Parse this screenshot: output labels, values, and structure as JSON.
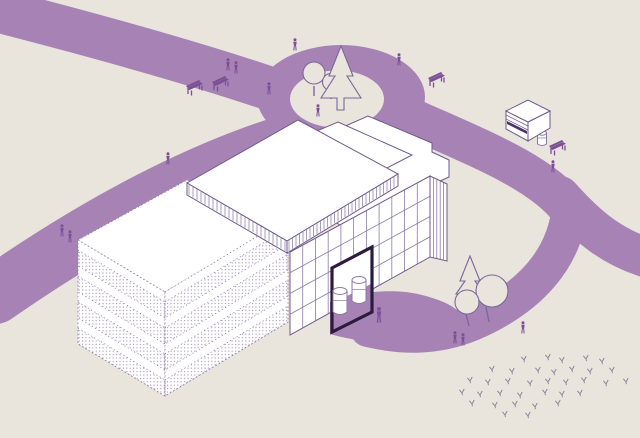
{
  "scene": {
    "kind": "isometric-architectural-site-illustration",
    "width": 640,
    "height": 438
  },
  "colors": {
    "background": "#e9e4dc",
    "road": "#a783b5",
    "solid_figure": "#7c4f97",
    "line_solid": "#6d5a8e",
    "line_dotted": "#9182ad",
    "glass_line": "#8a7aa8",
    "door_frame": "#2c1a3f",
    "grass": "#8b7d99",
    "tree_outline": "#7b689b",
    "dot_fill": "#a995bd",
    "hatch": "#8274a2",
    "white": "#ffffff",
    "kiosk_dark": "#4a3568"
  },
  "roads": {
    "ribbons": [
      {
        "name": "road-northwest",
        "d": "M-12,8 C90,34 190,62 268,88",
        "w": 44
      },
      {
        "name": "road-southwest",
        "d": "M292,142 C200,170 100,222 -5,295",
        "w": 58
      },
      {
        "name": "road-east",
        "d": "M398,112 C470,145 540,170 570,210",
        "w": 40
      },
      {
        "name": "road-east-branch",
        "d": "M560,196 C590,230 615,248 648,258",
        "w": 40
      },
      {
        "name": "road-entrance",
        "d": "M570,205 C566,258 530,298 472,323 C436,338 402,337 368,329",
        "w": 36
      }
    ],
    "roundabout": {
      "cx": 341,
      "cy": 97,
      "rx": 84,
      "ry": 52,
      "island_cx": 337,
      "island_cy": 99,
      "island_rx": 47,
      "island_ry": 28.5
    },
    "entrance_apron_d": "M330,302 C358,291 396,288 422,295 C446,301 459,309 461,316 C448,331 418,341 384,342 C362,342 344,338 330,334 Z",
    "door_floor": [
      [
        333,
        303
      ],
      [
        371,
        284
      ],
      [
        371,
        311
      ],
      [
        333,
        331
      ]
    ]
  },
  "building": {
    "wing": {
      "roof": [
        [
          78,
          240
        ],
        [
          187,
          180
        ],
        [
          290,
          218
        ],
        [
          165,
          292
        ]
      ],
      "end_face": [
        [
          78,
          240
        ],
        [
          165,
          292
        ],
        [
          165,
          396
        ],
        [
          78,
          344
        ]
      ],
      "front_face": [
        [
          165,
          292
        ],
        [
          288,
          218
        ],
        [
          288,
          322
        ],
        [
          165,
          396
        ]
      ],
      "bands": [
        [
          [
            78,
            250
          ],
          [
            165,
            302
          ],
          [
            165,
            318
          ],
          [
            78,
            266
          ]
        ],
        [
          [
            78,
            276
          ],
          [
            165,
            328
          ],
          [
            165,
            344
          ],
          [
            78,
            292
          ]
        ],
        [
          [
            78,
            302
          ],
          [
            165,
            354
          ],
          [
            165,
            370
          ],
          [
            78,
            318
          ]
        ],
        [
          [
            78,
            328
          ],
          [
            165,
            380
          ],
          [
            165,
            396
          ],
          [
            78,
            344
          ]
        ],
        [
          [
            165,
            302
          ],
          [
            288,
            228
          ],
          [
            288,
            244
          ],
          [
            165,
            318
          ]
        ],
        [
          [
            165,
            328
          ],
          [
            288,
            254
          ],
          [
            288,
            270
          ],
          [
            165,
            344
          ]
        ],
        [
          [
            165,
            354
          ],
          [
            288,
            280
          ],
          [
            288,
            296
          ],
          [
            165,
            370
          ]
        ],
        [
          [
            165,
            380
          ],
          [
            288,
            306
          ],
          [
            288,
            322
          ],
          [
            165,
            396
          ]
        ]
      ]
    },
    "main_roof": [
      [
        250,
        168
      ],
      [
        368,
        116
      ],
      [
        432,
        143
      ],
      [
        432,
        152
      ],
      [
        449,
        160
      ],
      [
        449,
        177
      ],
      [
        340,
        225
      ]
    ],
    "mid_roof": [
      [
        225,
        170
      ],
      [
        338,
        122
      ],
      [
        412,
        155
      ],
      [
        300,
        213
      ]
    ],
    "slab": [
      [
        187,
        183
      ],
      [
        298,
        120
      ],
      [
        398,
        174
      ],
      [
        287,
        241
      ]
    ],
    "fascia_right": {
      "pts": [
        [
          287,
          241
        ],
        [
          398,
          174
        ],
        [
          398,
          186
        ],
        [
          287,
          253
        ]
      ],
      "x0": 289,
      "x1": 397,
      "step": 3.5,
      "y_ref": 241,
      "x_ref": 287,
      "slope": -0.604,
      "tick": 11
    },
    "fascia_left": {
      "pts": [
        [
          187,
          183
        ],
        [
          287,
          241
        ],
        [
          287,
          253
        ],
        [
          187,
          195
        ]
      ],
      "x0": 189,
      "x1": 286,
      "step": 4,
      "y_ref": 183,
      "x_ref": 187,
      "slope": 0.58,
      "tick": 11
    },
    "glass_face": {
      "pts": [
        [
          290,
          252
        ],
        [
          430,
          176
        ],
        [
          430,
          257
        ],
        [
          290,
          335
        ]
      ],
      "n_vert": 10,
      "n_horiz": 3
    },
    "right_wall": {
      "pts": [
        [
          430,
          176
        ],
        [
          447,
          184
        ],
        [
          447,
          261
        ],
        [
          430,
          257
        ]
      ],
      "n_stripes": 4
    },
    "door": {
      "pts": [
        [
          332,
          268
        ],
        [
          372,
          247
        ],
        [
          372,
          312
        ],
        [
          332,
          332
        ]
      ],
      "stroke_w": 3.2
    }
  },
  "bins": [
    {
      "cx": 340,
      "top": 291,
      "rx": 7,
      "h": 21
    },
    {
      "cx": 359,
      "top": 280,
      "rx": 7,
      "h": 21
    },
    {
      "cx": 542,
      "top": 133,
      "rx": 4.5,
      "h": 11
    }
  ],
  "kiosk": {
    "top": [
      [
        506,
        111
      ],
      [
        528,
        100
      ],
      [
        550,
        111
      ],
      [
        528,
        122
      ]
    ],
    "left_face": [
      [
        506,
        111
      ],
      [
        528,
        122
      ],
      [
        528,
        141
      ],
      [
        506,
        129
      ]
    ],
    "right_face": [
      [
        528,
        122
      ],
      [
        550,
        111
      ],
      [
        550,
        128
      ],
      [
        528,
        141
      ]
    ],
    "stripes": [
      [
        506,
        115,
        528,
        126
      ],
      [
        506,
        119,
        528,
        130
      ]
    ],
    "slot": [
      [
        507,
        121
      ],
      [
        527,
        131
      ],
      [
        527,
        134
      ],
      [
        507,
        124
      ]
    ]
  },
  "trees": {
    "island": {
      "blobs": [
        [
          314,
          73,
          11
        ],
        [
          331,
          82,
          8.5
        ]
      ],
      "trunks": [
        [
          314,
          86,
          314,
          96
        ],
        [
          331,
          92,
          331,
          99
        ]
      ],
      "conifer_d": "M341,46 L329,76 L335,76 L321,98 L337,98 L337,110 L344,110 L344,98 L361,98 L347,76 L353,76 Z"
    },
    "east": {
      "conifer_d": "M470,256 L460,281 L465,281 L456,294 L484,294 L475,281 L480,281 Z",
      "blobs": [
        [
          492,
          291,
          16
        ],
        [
          467,
          302,
          12
        ]
      ],
      "trunks": [
        [
          466,
          314,
          469,
          326
        ],
        [
          486,
          307,
          489,
          322
        ]
      ]
    }
  },
  "benches": [
    {
      "x": 186,
      "y": 82
    },
    {
      "x": 212,
      "y": 78
    },
    {
      "x": 428,
      "y": 74
    },
    {
      "x": 549,
      "y": 142
    }
  ],
  "figures": [
    {
      "x": 295,
      "y": 46
    },
    {
      "x": 269,
      "y": 90
    },
    {
      "x": 318,
      "y": 112
    },
    {
      "x": 399,
      "y": 61
    },
    {
      "x": 228,
      "y": 66
    },
    {
      "x": 236,
      "y": 69
    },
    {
      "x": 62,
      "y": 232
    },
    {
      "x": 70,
      "y": 238
    },
    {
      "x": 168,
      "y": 160
    },
    {
      "x": 553,
      "y": 168
    },
    {
      "x": 379,
      "y": 317,
      "s": 1.3
    },
    {
      "x": 455,
      "y": 339
    },
    {
      "x": 463,
      "y": 341
    },
    {
      "x": 523,
      "y": 329
    }
  ],
  "grass": [
    [
      524,
      360
    ],
    [
      548,
      358
    ],
    [
      562,
      361
    ],
    [
      586,
      359
    ],
    [
      602,
      362
    ],
    [
      492,
      370
    ],
    [
      512,
      372
    ],
    [
      538,
      371
    ],
    [
      554,
      373
    ],
    [
      572,
      370
    ],
    [
      590,
      372
    ],
    [
      612,
      371
    ],
    [
      470,
      381
    ],
    [
      488,
      383
    ],
    [
      508,
      382
    ],
    [
      530,
      384
    ],
    [
      548,
      382
    ],
    [
      566,
      383
    ],
    [
      584,
      381
    ],
    [
      606,
      384
    ],
    [
      626,
      382
    ],
    [
      462,
      393
    ],
    [
      480,
      395
    ],
    [
      500,
      394
    ],
    [
      520,
      396
    ],
    [
      545,
      393
    ],
    [
      562,
      395
    ],
    [
      580,
      394
    ],
    [
      472,
      404
    ],
    [
      495,
      406
    ],
    [
      515,
      405
    ],
    [
      535,
      407
    ],
    [
      558,
      404
    ],
    [
      505,
      415
    ],
    [
      528,
      416
    ]
  ]
}
